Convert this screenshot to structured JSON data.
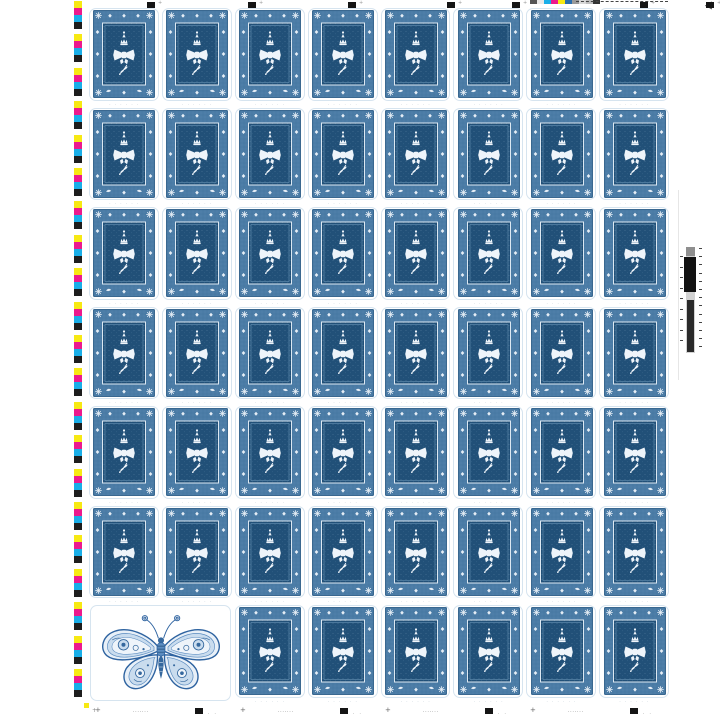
{
  "window": {
    "width": 720,
    "height": 720,
    "background": "#ffffff"
  },
  "sheet": {
    "type": "uncut press sheet of stamps",
    "columns": 8,
    "rows": 7,
    "stamp_count": 54,
    "butterfly_pane": {
      "row": 7,
      "column_start": 1,
      "column_span": 2
    }
  },
  "stamp": {
    "band_color": "#4b7ca6",
    "band_edge_color": "#3a6890",
    "panel_color": "#215078",
    "ornament_color": "#eef4fa",
    "frame_color": "#ffffff",
    "diecut_line_color": "#d6e4ef",
    "micro_marks": "· · · · · ·"
  },
  "butterfly": {
    "outline_color": "#2e63a0",
    "mid_color": "#5b8cc0",
    "band_fill": "#c9dcee",
    "wing_fill": "#e8f0f8",
    "accent_color": "#35689e"
  },
  "print_marks": {
    "cmyk_patches": {
      "yellow": "#f7e913",
      "magenta": "#ec1a8d",
      "cyan": "#19aee8",
      "black": "#1d1d1d"
    },
    "left_patch_group_count": 21,
    "register_square_color": "#151515",
    "registration_plus": "+",
    "top_mini_strip_colors": [
      "#555555",
      "#e8e8e8",
      "#19aee8",
      "#ec1a8d",
      "#f7e913",
      "#2b6fae",
      "#9a9a9a",
      "#d8d8d8",
      "#bfbfbf",
      "#333333"
    ],
    "density_strip": {
      "background": "#d2d2d2",
      "cap_color": "#8f8f8f",
      "block1_color": "#121212",
      "block2_color": "#2a2a2a",
      "tick_color": "#444444",
      "tick_count": 13
    },
    "micro_dash_text": "·······",
    "bottom_dot_text": "· ·",
    "corner_mark_color": "#f7e913"
  }
}
